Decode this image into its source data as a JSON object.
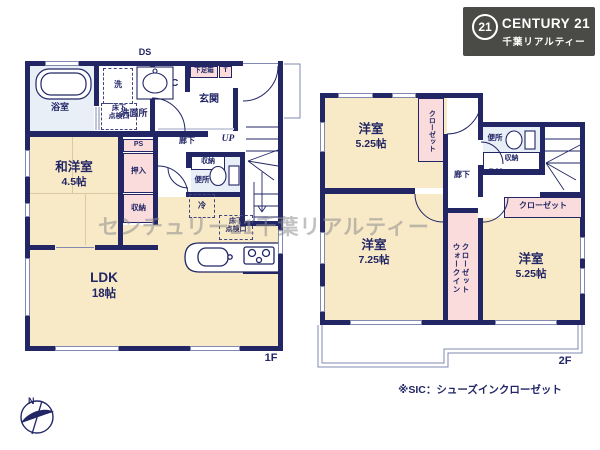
{
  "logo": {
    "seal": "21",
    "brand": "CENTURY 21",
    "company": "千葉リアルティー"
  },
  "watermark": "センチュリー21千葉リアルティー",
  "note": "※SIC：シューズインクローゼット",
  "compass": {
    "north": "N"
  },
  "colors": {
    "wall": "#222665",
    "room_cream": "#f8e9c7",
    "closet_pink": "#fadcdc",
    "wet_blue": "#e9eff7",
    "logo_bg": "#4a4a47"
  },
  "floor1": {
    "label": "1F",
    "ds": "DS",
    "bath": "浴室",
    "washer": "洗",
    "underfloor_hatch": "床下\n点検口",
    "washroom": "洗面所",
    "sic": "SIC",
    "shoe_box": "下足箱",
    "t_box": "T",
    "entrance": "玄関",
    "hallway": "廊下",
    "up": "UP",
    "ps": "PS",
    "oshiire": "押入",
    "storage_upper": "収納",
    "washitsu_name": "和洋室",
    "washitsu_size": "4.5帖",
    "storage_hall": "収納",
    "toilet": "便所",
    "fridge": "冷",
    "underfloor_hatch2": "床下\n点検口",
    "ldk_name": "LDK",
    "ldk_size": "18帖"
  },
  "floor2": {
    "label": "2F",
    "bedroom1_name": "洋室",
    "bedroom1_size": "5.25帖",
    "closet1": "クローゼット",
    "toilet": "便所",
    "storage": "収納",
    "hallway": "廊下",
    "dn": "DN",
    "closet2": "クローゼット",
    "bedroom2_name": "洋室",
    "bedroom2_size": "7.25帖",
    "wic": "ウォークイン\nクローゼット",
    "bedroom3_name": "洋室",
    "bedroom3_size": "5.25帖"
  }
}
